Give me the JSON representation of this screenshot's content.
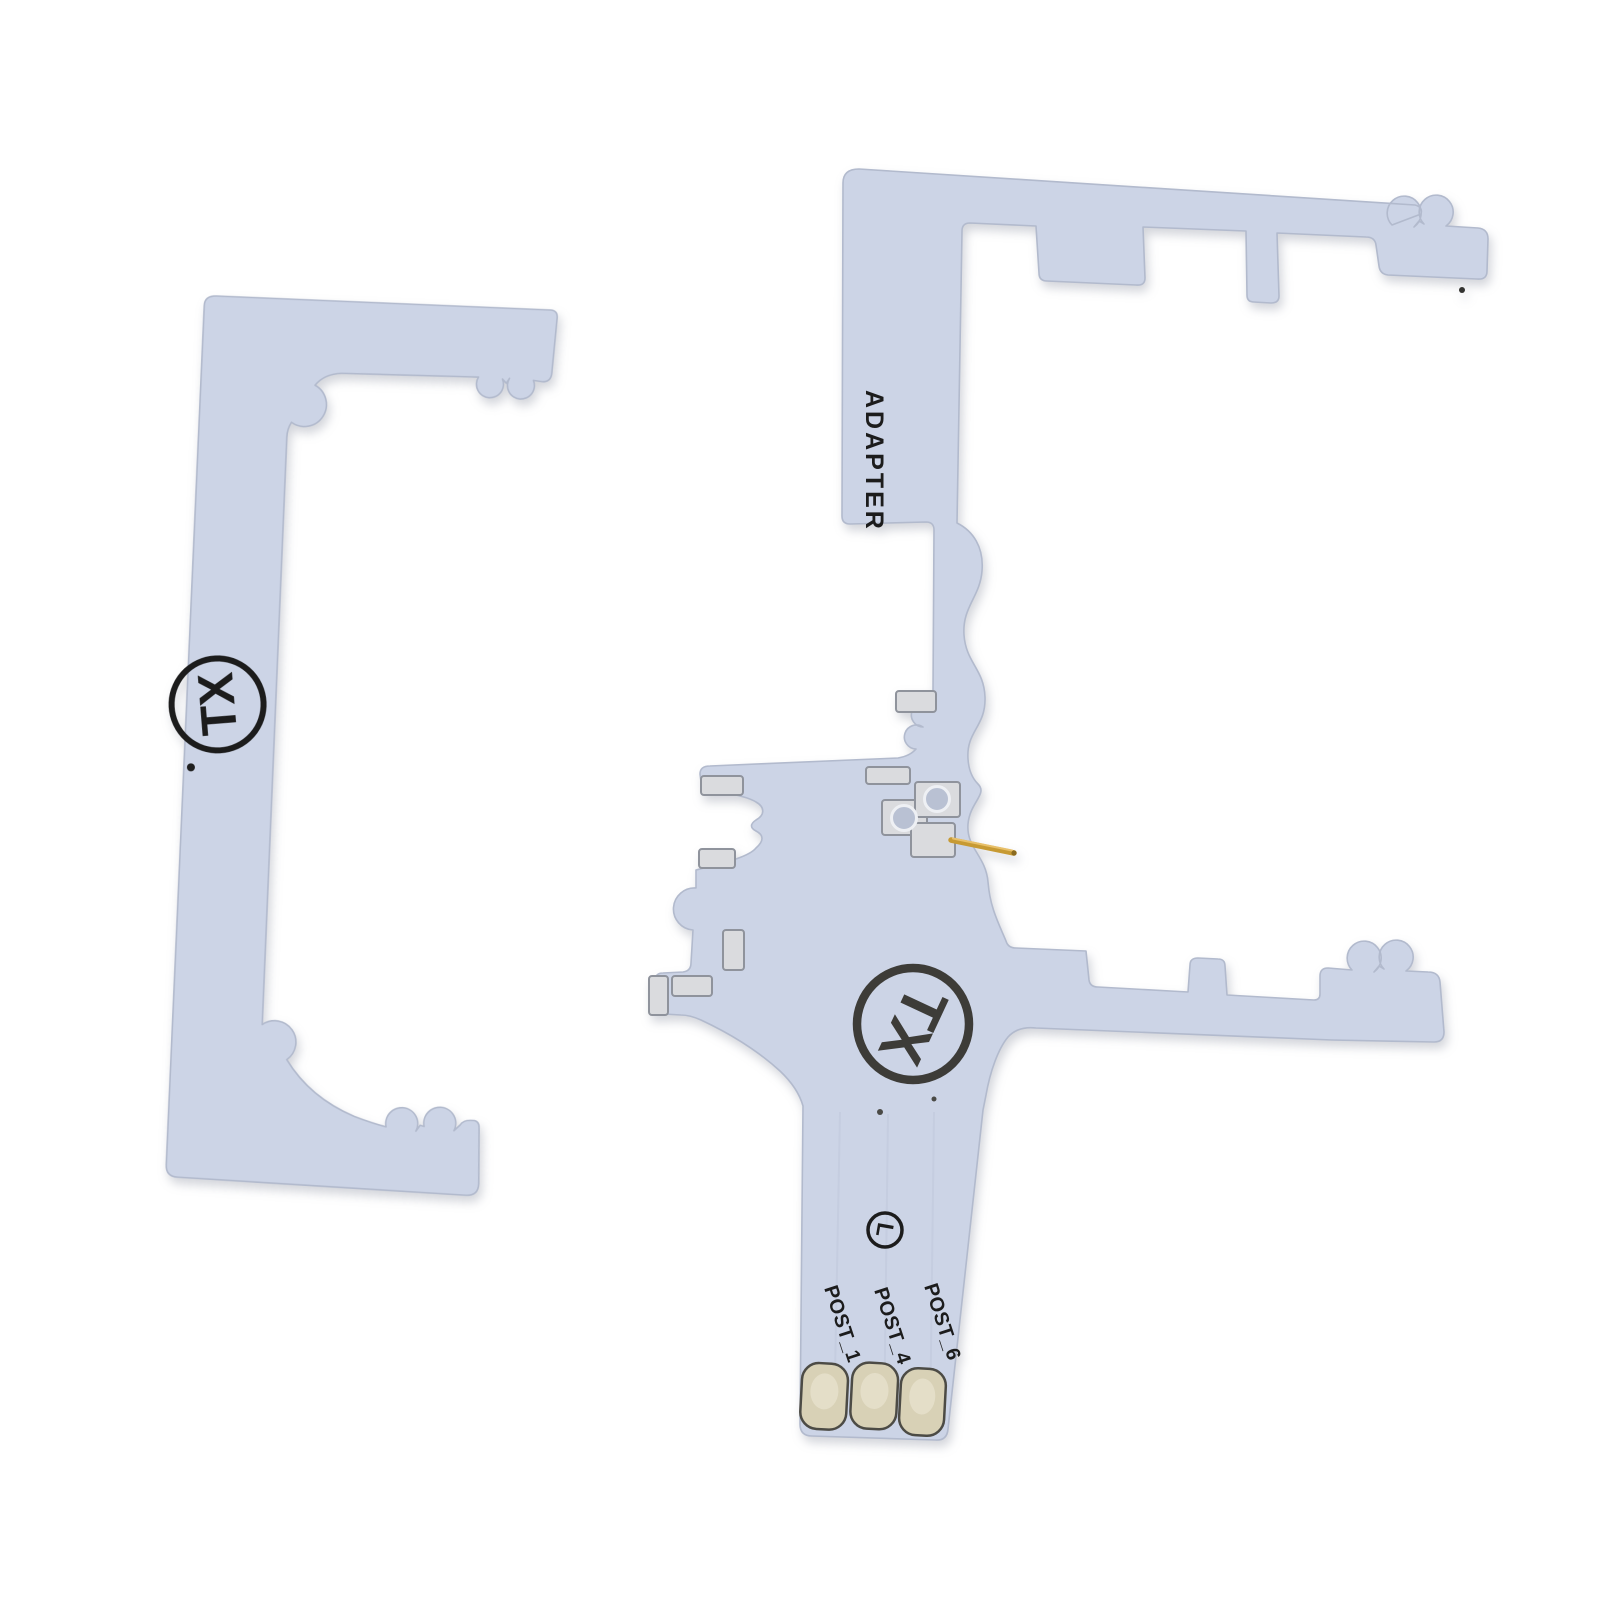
{
  "photo": {
    "background": "#ffffff"
  },
  "colors": {
    "board": "#ccd4e6",
    "board_edge": "#b2bacd",
    "board_inner_shade": "#c3cbe0",
    "pad": "#dadbde",
    "pad_edge": "#8f939c",
    "via": "#b9c1d3",
    "via_rim": "#eef0f4",
    "gold_pin": "#c79a33",
    "gold_pin_highlight": "#e8c06a",
    "ink": "#1c1c1c",
    "logo_ink": "#3d3c38",
    "contact_pad": "#d8d1b6",
    "contact_pad_inner": "#e7e1cd",
    "contact_pad_edge": "#4c4b45",
    "trace": "#c5cde0"
  },
  "left_board": {
    "logo_text": "TX"
  },
  "right_board": {
    "side_label": "ADAPTER",
    "logo_text": "TX",
    "circled_marking": "L",
    "post_labels": [
      "POST_1",
      "POST_4",
      "POST_6"
    ]
  }
}
